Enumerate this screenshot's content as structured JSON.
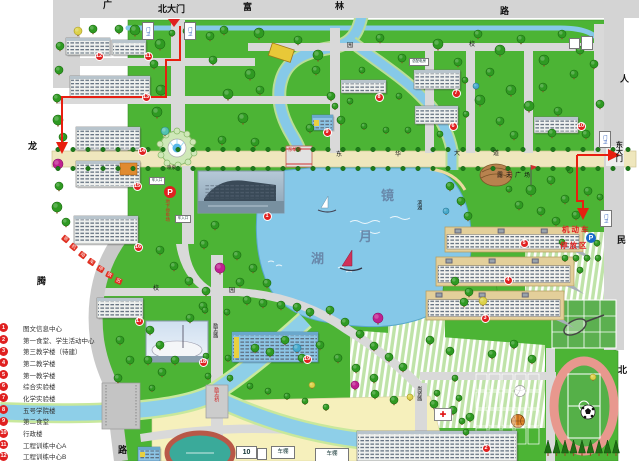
{
  "accent_colors": {
    "route_red": "#e81e10",
    "badge_red": "#e02020",
    "water_blue": "#86c9e8",
    "lawn_green": "#4cb435",
    "avenue_tan": "#efe7bd"
  },
  "legend": {
    "items": [
      {
        "num": "1",
        "label": "图文信息中心"
      },
      {
        "num": "2",
        "label": "第一食堂、学生活动中心"
      },
      {
        "num": "3",
        "label": "第三教学楼（待建）"
      },
      {
        "num": "4",
        "label": "第二教学楼"
      },
      {
        "num": "5",
        "label": "第一教学楼"
      },
      {
        "num": "6",
        "label": "综合实验楼"
      },
      {
        "num": "7",
        "label": "化学实验楼"
      },
      {
        "num": "8",
        "label": "五号学院楼"
      },
      {
        "num": "9",
        "label": "第二食堂"
      },
      {
        "num": "10",
        "label": "行政楼"
      },
      {
        "num": "11",
        "label": "工程训练中心A"
      },
      {
        "num": "12",
        "label": "工程训练中心B"
      }
    ]
  },
  "labels": [
    {
      "id": "road-guang",
      "t": "广",
      "x": 103,
      "y": 1,
      "s": 9,
      "b": 1
    },
    {
      "id": "north-gate",
      "t": "北大门",
      "x": 158,
      "y": 5,
      "s": 9,
      "b": 1
    },
    {
      "id": "road-fu",
      "t": "富",
      "x": 243,
      "y": 3,
      "s": 9,
      "b": 1
    },
    {
      "id": "road-lin",
      "t": "林",
      "x": 335,
      "y": 2,
      "s": 9,
      "b": 1
    },
    {
      "id": "road-lu-top",
      "t": "路",
      "x": 500,
      "y": 7,
      "s": 9,
      "b": 1
    },
    {
      "id": "road-ren",
      "t": "人",
      "x": 620,
      "y": 75,
      "s": 9,
      "b": 1
    },
    {
      "id": "road-min",
      "t": "民",
      "x": 617,
      "y": 236,
      "s": 9,
      "b": 1
    },
    {
      "id": "road-bei",
      "t": "北",
      "x": 618,
      "y": 366,
      "s": 9,
      "b": 1
    },
    {
      "id": "road-long",
      "t": "龙",
      "x": 28,
      "y": 142,
      "s": 9,
      "b": 1
    },
    {
      "id": "road-teng",
      "t": "腾",
      "x": 37,
      "y": 277,
      "s": 9,
      "b": 1
    },
    {
      "id": "road-lu-left",
      "t": "路",
      "x": 118,
      "y": 446,
      "s": 9,
      "b": 1
    },
    {
      "id": "east-gate",
      "t": "东大门",
      "x": 615,
      "y": 141,
      "s": 7,
      "b": 1,
      "v": 1
    },
    {
      "id": "ring-xiao-n",
      "t": "校",
      "x": 469,
      "y": 42,
      "s": 6
    },
    {
      "id": "ring-yuan-n",
      "t": "园",
      "x": 347,
      "y": 43,
      "s": 6
    },
    {
      "id": "ring-xiao-s",
      "t": "校",
      "x": 153,
      "y": 286,
      "s": 6
    },
    {
      "id": "ring-yuan-s",
      "t": "园",
      "x": 229,
      "y": 288,
      "s": 6
    },
    {
      "id": "avenue-dong",
      "t": "东",
      "x": 336,
      "y": 152,
      "s": 6
    },
    {
      "id": "avenue-hua",
      "t": "华",
      "x": 395,
      "y": 152,
      "s": 6
    },
    {
      "id": "avenue-da",
      "t": "大",
      "x": 454,
      "y": 151,
      "s": 6
    },
    {
      "id": "avenue-dao",
      "t": "道",
      "x": 493,
      "y": 151,
      "s": 6
    },
    {
      "id": "donghua-bridge",
      "t": "东华桥",
      "x": 288,
      "y": 148,
      "s": 4.5,
      "c": "#d02020"
    },
    {
      "id": "lizhi-road",
      "t": "励志路",
      "x": 212,
      "y": 323,
      "s": 5,
      "v": 1
    },
    {
      "id": "lizhi-bridge",
      "t": "励志桥",
      "x": 213,
      "y": 387,
      "s": 5,
      "c": "#d02020",
      "v": 1
    },
    {
      "id": "shangxian-road",
      "t": "尚贤路",
      "x": 416,
      "y": 386,
      "s": 5,
      "v": 1
    },
    {
      "id": "binhu-road",
      "t": "滨湖",
      "x": 416,
      "y": 200,
      "s": 5,
      "v": 1
    },
    {
      "id": "lake-jing",
      "t": "镜",
      "x": 381,
      "y": 189,
      "s": 13,
      "c": "#6888aa",
      "b": 1
    },
    {
      "id": "lake-yue",
      "t": "月",
      "x": 359,
      "y": 230,
      "s": 13,
      "c": "#6888aa",
      "b": 1
    },
    {
      "id": "lake-hu",
      "t": "湖",
      "x": 311,
      "y": 252,
      "s": 13,
      "c": "#6888aa",
      "b": 1
    },
    {
      "id": "fountain-label",
      "t": "喷泉",
      "x": 167,
      "y": 166,
      "s": 4.5
    },
    {
      "id": "underground-parking",
      "t": "地下停车场",
      "x": 165,
      "y": 199,
      "s": 4.5,
      "c": "#e02020",
      "v": 1
    },
    {
      "id": "open-plaza",
      "t": "露天广场",
      "x": 497,
      "y": 173,
      "s": 6,
      "ls": 3
    },
    {
      "id": "motor-park-1",
      "t": "机动车",
      "x": 562,
      "y": 226,
      "s": 7.5,
      "c": "#e02020",
      "b": 1,
      "ls": 2
    },
    {
      "id": "motor-park-2",
      "t": "停放区",
      "x": 560,
      "y": 242,
      "s": 7.5,
      "c": "#e02020",
      "b": 1,
      "ls": 2
    }
  ],
  "boxes": [
    {
      "id": "guard-north-w",
      "t": "门卫",
      "x": 142,
      "y": 22,
      "w": 10,
      "h": 16,
      "s": 4.5,
      "c": "#2858b8",
      "v": 1
    },
    {
      "id": "guard-north-e",
      "t": "门卫",
      "x": 184,
      "y": 22,
      "w": 10,
      "h": 16,
      "s": 4.5,
      "c": "#2858b8",
      "v": 1
    },
    {
      "id": "guard-east-n",
      "t": "门卫",
      "x": 599,
      "y": 131,
      "w": 10,
      "h": 15,
      "s": 4.5,
      "c": "#2858b8",
      "v": 1
    },
    {
      "id": "guard-east-s",
      "t": "门卫",
      "x": 600,
      "y": 210,
      "w": 10,
      "h": 15,
      "s": 4.5,
      "c": "#2858b8",
      "v": 1
    },
    {
      "id": "car-entry-1",
      "t": "车入口",
      "x": 149,
      "y": 177,
      "w": 14,
      "h": 6,
      "s": 3.5
    },
    {
      "id": "car-entry-2",
      "t": "车入口",
      "x": 175,
      "y": 215,
      "w": 14,
      "h": 6,
      "s": 3.5
    },
    {
      "id": "power-house",
      "t": "总配电房",
      "x": 409,
      "y": 58,
      "w": 18,
      "h": 6,
      "s": 3.5
    },
    {
      "id": "stand-10",
      "t": "10",
      "x": 236,
      "y": 446,
      "w": 19,
      "h": 11,
      "s": 7,
      "b": 1
    },
    {
      "id": "small-shed",
      "t": "",
      "x": 257,
      "y": 448,
      "w": 8,
      "h": 10,
      "s": 4
    },
    {
      "id": "bike-shed-1",
      "t": "车棚",
      "x": 271,
      "y": 446,
      "w": 22,
      "h": 11,
      "s": 5.5
    },
    {
      "id": "bike-shed-2",
      "t": "车棚",
      "x": 315,
      "y": 448,
      "w": 32,
      "h": 12,
      "s": 5.5
    },
    {
      "id": "corner-hut-1",
      "t": "",
      "x": 569,
      "y": 38,
      "w": 9,
      "h": 9,
      "s": 3
    },
    {
      "id": "corner-hut-2",
      "t": "",
      "x": 581,
      "y": 36,
      "w": 10,
      "h": 12,
      "s": 3
    }
  ],
  "badges": [
    {
      "n": "1",
      "x": 267,
      "y": 216
    },
    {
      "n": "2",
      "x": 486,
      "y": 448
    },
    {
      "n": "3",
      "x": 485,
      "y": 318
    },
    {
      "n": "4",
      "x": 508,
      "y": 280
    },
    {
      "n": "5",
      "x": 524,
      "y": 243
    },
    {
      "n": "6",
      "x": 453,
      "y": 126
    },
    {
      "n": "7",
      "x": 456,
      "y": 93
    },
    {
      "n": "8",
      "x": 379,
      "y": 97
    },
    {
      "n": "9",
      "x": 327,
      "y": 132
    },
    {
      "n": "10",
      "x": 581,
      "y": 126
    },
    {
      "n": "11",
      "x": 148,
      "y": 56
    },
    {
      "n": "12",
      "x": 99,
      "y": 56
    },
    {
      "n": "13",
      "x": 146,
      "y": 97
    },
    {
      "n": "14",
      "x": 142,
      "y": 151
    },
    {
      "n": "15",
      "x": 137,
      "y": 186
    },
    {
      "n": "16",
      "x": 138,
      "y": 247
    },
    {
      "n": "17",
      "x": 139,
      "y": 321
    },
    {
      "n": "18",
      "x": 203,
      "y": 362
    },
    {
      "n": "19",
      "x": 307,
      "y": 359
    }
  ],
  "parking_icons": [
    {
      "id": "p-underground",
      "x": 164,
      "y": 186,
      "d": 12,
      "bg": "#e02020",
      "t": "P"
    },
    {
      "id": "p-motor",
      "x": 586,
      "y": 233,
      "d": 10,
      "bg": "#1868c8",
      "t": "P"
    }
  ],
  "banner": {
    "text": "非机动车停放区",
    "tiles": [
      [
        62,
        236,
        40
      ],
      [
        70,
        244,
        40
      ],
      [
        79,
        252,
        38
      ],
      [
        88,
        259,
        34
      ],
      [
        97,
        266,
        30
      ],
      [
        106,
        272,
        26
      ],
      [
        115,
        278,
        22
      ]
    ]
  },
  "medical": {
    "id": "clinic",
    "x": 434,
    "y": 408,
    "w": 16,
    "h": 11,
    "symbol": "✚"
  },
  "buildings": [
    {
      "id": "building-12",
      "x": 66,
      "y": 38,
      "w": 44,
      "h": 17,
      "type": "white"
    },
    {
      "id": "building-11",
      "x": 112,
      "y": 40,
      "w": 34,
      "h": 15,
      "type": "white"
    },
    {
      "id": "building-13",
      "x": 70,
      "y": 76,
      "w": 80,
      "h": 21,
      "type": "white"
    },
    {
      "id": "building-14",
      "x": 76,
      "y": 127,
      "w": 64,
      "h": 23,
      "type": "white"
    },
    {
      "id": "building-15",
      "x": 76,
      "y": 161,
      "w": 64,
      "h": 26,
      "type": "white",
      "accent": 1
    },
    {
      "id": "building-16",
      "x": 74,
      "y": 216,
      "w": 64,
      "h": 28,
      "type": "white"
    },
    {
      "id": "building-17",
      "x": 97,
      "y": 298,
      "w": 46,
      "h": 20,
      "type": "white"
    },
    {
      "id": "building-19",
      "x": 232,
      "y": 332,
      "w": 86,
      "h": 30,
      "type": "blue"
    },
    {
      "id": "building-7",
      "x": 414,
      "y": 70,
      "w": 46,
      "h": 19,
      "type": "white"
    },
    {
      "id": "building-6",
      "x": 415,
      "y": 106,
      "w": 43,
      "h": 18,
      "type": "white"
    },
    {
      "id": "building-8",
      "x": 341,
      "y": 80,
      "w": 45,
      "h": 13,
      "type": "white"
    },
    {
      "id": "building-9",
      "x": 312,
      "y": 115,
      "w": 21,
      "h": 15,
      "type": "blue"
    },
    {
      "id": "building-10",
      "x": 534,
      "y": 117,
      "w": 44,
      "h": 16,
      "type": "white"
    },
    {
      "id": "building-5",
      "x": 445,
      "y": 227,
      "w": 138,
      "h": 25,
      "type": "terrace"
    },
    {
      "id": "building-4",
      "x": 436,
      "y": 257,
      "w": 138,
      "h": 29,
      "type": "terrace"
    },
    {
      "id": "building-3",
      "x": 426,
      "y": 291,
      "w": 138,
      "h": 29,
      "type": "terrace"
    },
    {
      "id": "building-2",
      "x": 357,
      "y": 431,
      "w": 160,
      "h": 30,
      "type": "white"
    },
    {
      "id": "building-gym",
      "x": 138,
      "y": 447,
      "w": 22,
      "h": 14,
      "type": "blue"
    }
  ],
  "photos": [
    {
      "id": "photo-library",
      "x": 198,
      "y": 171,
      "w": 86,
      "h": 42
    },
    {
      "id": "photo-arena",
      "x": 146,
      "y": 321,
      "w": 62,
      "h": 41
    }
  ],
  "trees": [
    [
      135,
      30,
      5
    ],
    [
      148,
      27,
      4
    ],
    [
      160,
      44,
      5
    ],
    [
      154,
      64,
      4
    ],
    [
      161,
      90,
      5
    ],
    [
      157,
      112,
      5
    ],
    [
      165,
      131,
      4,
      "t"
    ],
    [
      172,
      33,
      3
    ],
    [
      186,
      31,
      3
    ],
    [
      78,
      31,
      4,
      "y"
    ],
    [
      93,
      29,
      4
    ],
    [
      119,
      29,
      4
    ],
    [
      60,
      46,
      4
    ],
    [
      59,
      70,
      4
    ],
    [
      57,
      98,
      4
    ],
    [
      58,
      120,
      5
    ],
    [
      63,
      137,
      4
    ],
    [
      58,
      164,
      5,
      "m"
    ],
    [
      59,
      186,
      4
    ],
    [
      57,
      207,
      5
    ],
    [
      66,
      222,
      4
    ],
    [
      210,
      36,
      4
    ],
    [
      224,
      30,
      4
    ],
    [
      259,
      33,
      5
    ],
    [
      298,
      40,
      4
    ],
    [
      318,
      55,
      5
    ],
    [
      250,
      74,
      5
    ],
    [
      228,
      94,
      5
    ],
    [
      213,
      60,
      4
    ],
    [
      260,
      90,
      4
    ],
    [
      243,
      118,
      5
    ],
    [
      222,
      140,
      4
    ],
    [
      255,
      142,
      4
    ],
    [
      310,
      128,
      4
    ],
    [
      316,
      70,
      4
    ],
    [
      331,
      96,
      4
    ],
    [
      341,
      120,
      4
    ],
    [
      380,
      38,
      4
    ],
    [
      402,
      58,
      4
    ],
    [
      438,
      44,
      5
    ],
    [
      458,
      62,
      4
    ],
    [
      478,
      34,
      4
    ],
    [
      500,
      50,
      5
    ],
    [
      521,
      39,
      4
    ],
    [
      544,
      60,
      5
    ],
    [
      562,
      34,
      4
    ],
    [
      580,
      50,
      4
    ],
    [
      490,
      72,
      4
    ],
    [
      511,
      90,
      5
    ],
    [
      543,
      87,
      4
    ],
    [
      574,
      74,
      4
    ],
    [
      594,
      64,
      4
    ],
    [
      480,
      100,
      5
    ],
    [
      500,
      121,
      4
    ],
    [
      529,
      106,
      5
    ],
    [
      558,
      111,
      4
    ],
    [
      586,
      134,
      4
    ],
    [
      600,
      104,
      4
    ],
    [
      476,
      86,
      3,
      "b"
    ],
    [
      514,
      135,
      4
    ],
    [
      552,
      133,
      4
    ],
    [
      399,
      96,
      3
    ],
    [
      408,
      130,
      3
    ],
    [
      440,
      134,
      3
    ],
    [
      465,
      80,
      3
    ],
    [
      466,
      114,
      3
    ],
    [
      362,
      70,
      3
    ],
    [
      350,
      101,
      3
    ],
    [
      335,
      106,
      3
    ],
    [
      364,
      126,
      3
    ],
    [
      386,
      130,
      3
    ],
    [
      450,
      186,
      4
    ],
    [
      461,
      201,
      4
    ],
    [
      468,
      216,
      4
    ],
    [
      446,
      211,
      3,
      "b"
    ],
    [
      531,
      190,
      5
    ],
    [
      551,
      180,
      4
    ],
    [
      565,
      199,
      4
    ],
    [
      541,
      211,
      4
    ],
    [
      519,
      205,
      4
    ],
    [
      509,
      189,
      3
    ],
    [
      556,
      221,
      4
    ],
    [
      576,
      215,
      4
    ],
    [
      588,
      191,
      4
    ],
    [
      570,
      170,
      3
    ],
    [
      600,
      197,
      3
    ],
    [
      565,
      258,
      3
    ],
    [
      576,
      258,
      3
    ],
    [
      587,
      258,
      3
    ],
    [
      598,
      258,
      3
    ],
    [
      562,
      242,
      3
    ],
    [
      597,
      243,
      3
    ],
    [
      580,
      270,
      3
    ],
    [
      215,
      225,
      4
    ],
    [
      204,
      244,
      4
    ],
    [
      160,
      250,
      4
    ],
    [
      174,
      266,
      4
    ],
    [
      189,
      281,
      4
    ],
    [
      206,
      291,
      4
    ],
    [
      220,
      268,
      5,
      "m"
    ],
    [
      237,
      255,
      4
    ],
    [
      253,
      268,
      4
    ],
    [
      267,
      283,
      4
    ],
    [
      240,
      282,
      4
    ],
    [
      203,
      306,
      4
    ],
    [
      190,
      318,
      4
    ],
    [
      120,
      340,
      4
    ],
    [
      130,
      360,
      4
    ],
    [
      118,
      378,
      4
    ],
    [
      150,
      330,
      4
    ],
    [
      160,
      345,
      4
    ],
    [
      148,
      360,
      4
    ],
    [
      162,
      372,
      4
    ],
    [
      175,
      360,
      4
    ],
    [
      152,
      388,
      3
    ],
    [
      247,
      300,
      4
    ],
    [
      263,
      303,
      4
    ],
    [
      281,
      305,
      4
    ],
    [
      297,
      307,
      4
    ],
    [
      310,
      312,
      4
    ],
    [
      297,
      348,
      4,
      "b"
    ],
    [
      285,
      340,
      4
    ],
    [
      270,
      352,
      4
    ],
    [
      255,
      348,
      4
    ],
    [
      302,
      358,
      4
    ],
    [
      320,
      345,
      4
    ],
    [
      338,
      358,
      4
    ],
    [
      356,
      368,
      4
    ],
    [
      374,
      378,
      4
    ],
    [
      378,
      318,
      5,
      "m"
    ],
    [
      330,
      310,
      4
    ],
    [
      345,
      322,
      4
    ],
    [
      360,
      334,
      4
    ],
    [
      374,
      346,
      4
    ],
    [
      389,
      357,
      4
    ],
    [
      403,
      367,
      4
    ],
    [
      455,
      281,
      4
    ],
    [
      469,
      292,
      4
    ],
    [
      483,
      301,
      4,
      "y"
    ],
    [
      464,
      302,
      4
    ],
    [
      205,
      310,
      3
    ],
    [
      227,
      312,
      3
    ],
    [
      206,
      356,
      3
    ],
    [
      228,
      358,
      3
    ],
    [
      208,
      376,
      3
    ],
    [
      230,
      378,
      3
    ],
    [
      355,
      385,
      4,
      "m"
    ],
    [
      312,
      385,
      3,
      "y"
    ],
    [
      375,
      394,
      4
    ],
    [
      394,
      400,
      4
    ],
    [
      410,
      397,
      3,
      "y"
    ],
    [
      434,
      404,
      4
    ],
    [
      453,
      410,
      4
    ],
    [
      470,
      417,
      4
    ],
    [
      250,
      386,
      3
    ],
    [
      268,
      391,
      3
    ],
    [
      287,
      396,
      3
    ],
    [
      305,
      401,
      3
    ],
    [
      326,
      407,
      3
    ],
    [
      430,
      340,
      4
    ],
    [
      450,
      351,
      4
    ],
    [
      492,
      354,
      4
    ],
    [
      514,
      344,
      4
    ],
    [
      532,
      359,
      4
    ],
    [
      455,
      378,
      3
    ],
    [
      437,
      393,
      3
    ],
    [
      459,
      398,
      3
    ],
    [
      441,
      413,
      3
    ],
    [
      462,
      421,
      3
    ],
    [
      466,
      432,
      3
    ],
    [
      593,
      377,
      3,
      "y"
    ]
  ]
}
